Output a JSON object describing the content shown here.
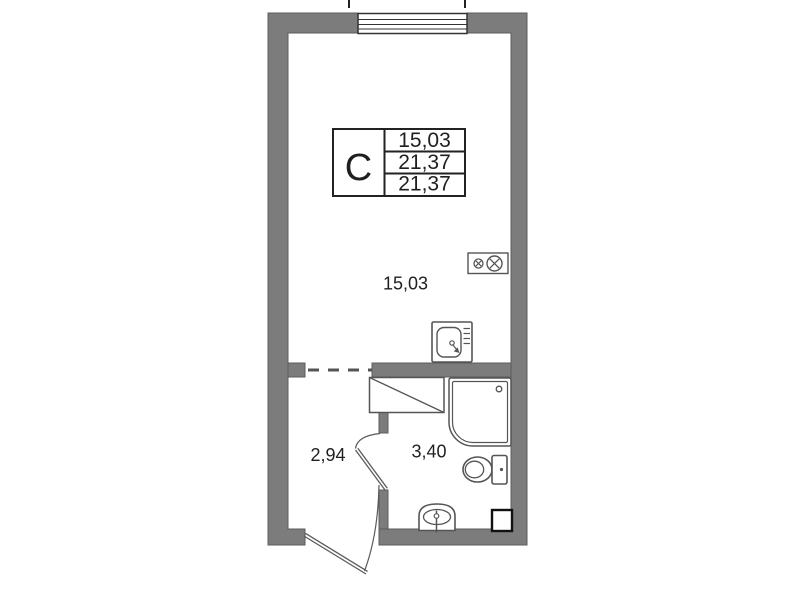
{
  "stamp": {
    "type_label": "С",
    "rows": [
      "15,03",
      "21,37",
      "21,37"
    ]
  },
  "labels": {
    "main_room_area": "15,03",
    "hallway_area": "2,94",
    "bathroom_area": "3,40"
  },
  "fixtures": {
    "window": "window-with-triple-glazing",
    "stove": "two-burner-stove-icon",
    "sink": "kitchen-sink-icon",
    "niche": "appliance-niche-with-diagonal",
    "shower": "shower-cabin-icon",
    "toilet": "toilet-icon",
    "washbasin": "washbasin-icon",
    "duct": "ventilation-duct-icon",
    "entry_door": "entry-door-swing",
    "bathroom_door": "bathroom-door-swing",
    "opening": "dashed-wall-opening"
  },
  "colors": {
    "wall_fill": "#7c7c7c",
    "wall_edge": "#5c5c5c",
    "fixture_line": "#555555",
    "stamp_border": "#222222",
    "text": "#1f1f1f",
    "background": "#ffffff"
  }
}
